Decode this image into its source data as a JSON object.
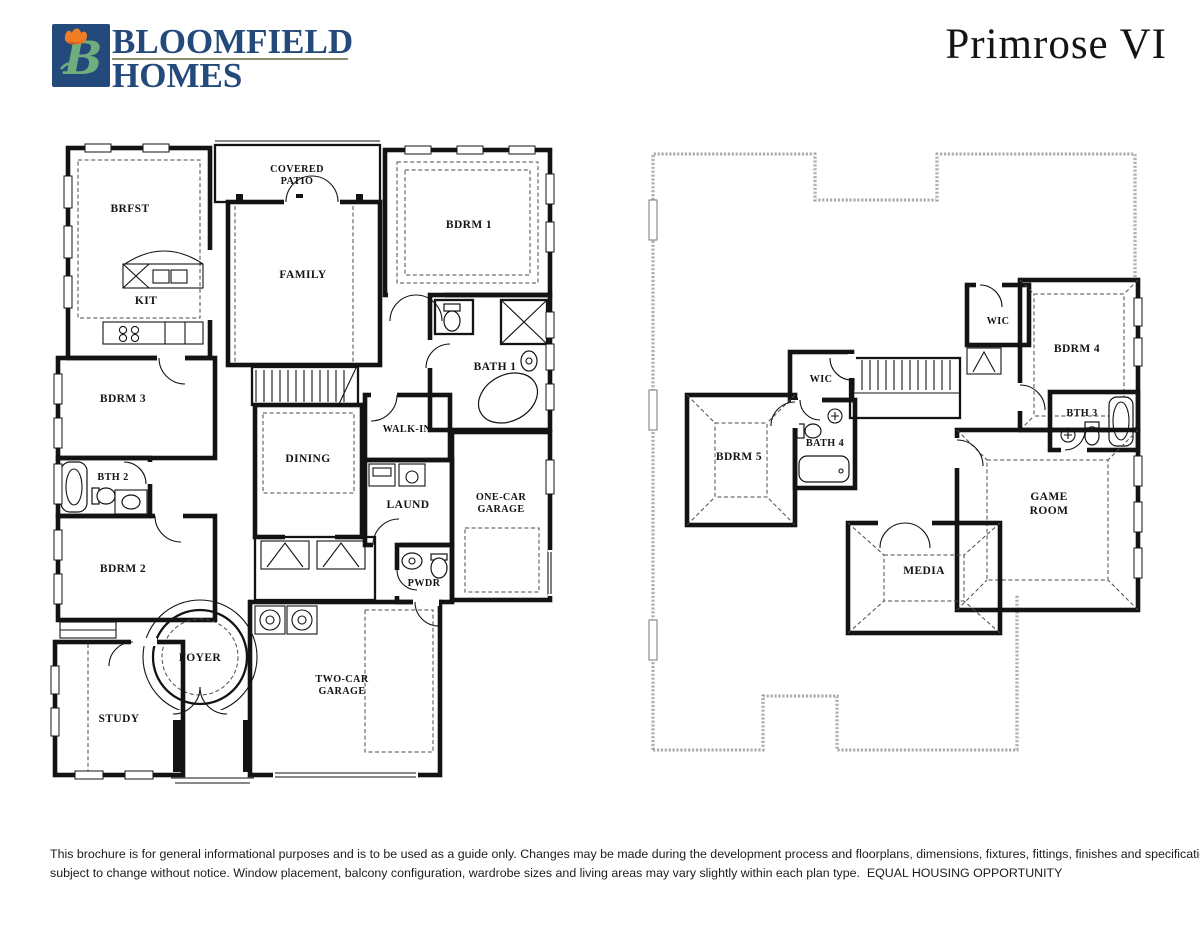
{
  "header": {
    "brand": {
      "line1": "BLOOMFIELD",
      "line2": "HOMES"
    },
    "logo_icon": "bloomfield-tulip-b-monogram",
    "plan_name": "Primrose VI"
  },
  "palette": {
    "brand_navy": "#24497B",
    "brand_green": "#6FAE7C",
    "tulip_orange": "#EF7D23",
    "tulip_red": "#CF3A1F",
    "rule_tan": "#8D8D71",
    "plan_ink": "#131313"
  },
  "first_floor": {
    "rooms": {
      "covered_patio": {
        "l1": "COVERED",
        "l2": "PATIO"
      },
      "brfst": "BRFST",
      "kit": "KIT",
      "family": "FAMILY",
      "bdrm1": "BDRM 1",
      "bath1": "BATH 1",
      "bdrm3": "BDRM 3",
      "walk_in": "WALK-IN",
      "dining": "DINING",
      "bth2": "BTH 2",
      "laund": "LAUND",
      "one_car_garage": {
        "l1": "ONE-CAR",
        "l2": "GARAGE"
      },
      "bdrm2": "BDRM 2",
      "pwdr": "PWDR",
      "foyer": "FOYER",
      "study": "STUDY",
      "two_car_garage": {
        "l1": "TWO-CAR",
        "l2": "GARAGE"
      }
    }
  },
  "second_floor": {
    "rooms": {
      "wic_a": "WIC",
      "bdrm4": "BDRM 4",
      "wic_b": "WIC",
      "bath4": "BATH 4",
      "bdrm5": "BDRM 5",
      "bth3": "BTH 3",
      "game_room": {
        "l1": "GAME",
        "l2": "ROOM"
      },
      "media": "MEDIA"
    }
  },
  "footer": {
    "line1": "This brochure is for general informational purposes and is to be used as a guide only. Changes may be made during the development process and floorplans, dimensions, fixtures, fittings, finishes and specifications are",
    "line2": "subject to change without notice. Window placement, balcony configuration, wardrobe sizes and living areas may vary slightly within each plan type.  EQUAL HOUSING OPPORTUNITY"
  }
}
